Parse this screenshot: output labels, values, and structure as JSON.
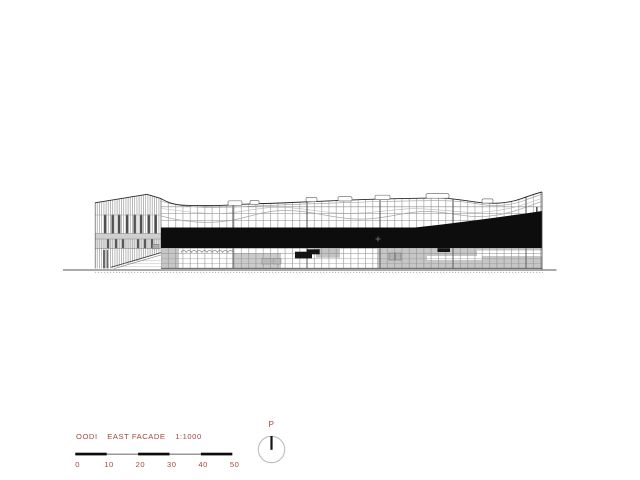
{
  "title_block": {
    "project": "OODI",
    "view": "EAST FACADE",
    "scale": "1:1000"
  },
  "scale_bar": {
    "labels": [
      "0",
      "10",
      "20",
      "30",
      "40",
      "50"
    ]
  },
  "compass": {
    "label": "P"
  },
  "colors": {
    "accent": "#a5473d",
    "ink": "#2f2f2f",
    "black_band": "#0d0d0d",
    "panel_gray": "#c6c6c6",
    "grid_gray": "#8a8a8a"
  }
}
